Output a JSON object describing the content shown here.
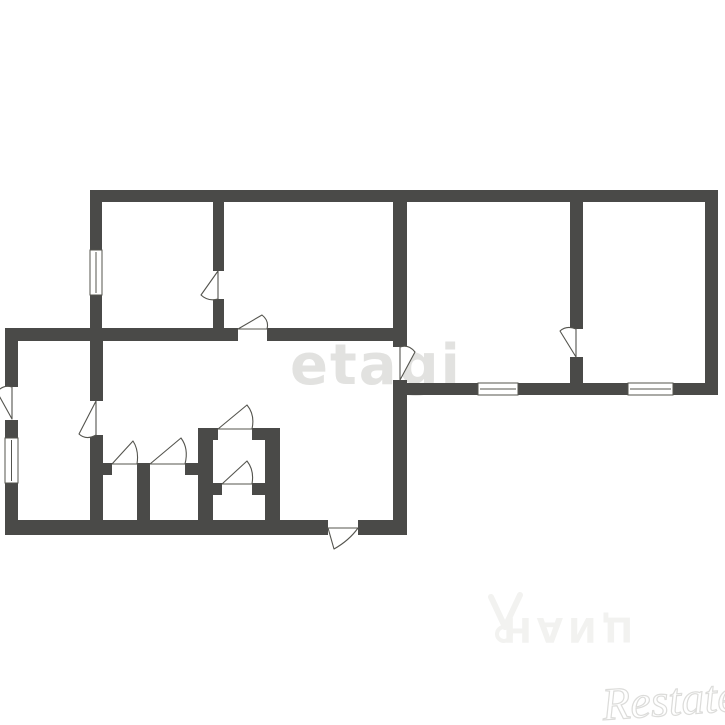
{
  "watermarks": {
    "etagi": {
      "text": "etagi",
      "color": "#e2e2e0"
    },
    "cian": {
      "text": "ЦИАН",
      "color": "#f2f2f0",
      "logo": "cian-person-pin-icon"
    },
    "restate": {
      "text": "Restate",
      "color": "#dcdcda"
    }
  },
  "plan": {
    "background": "#ffffff",
    "wall_color": "#4a4a48",
    "line_color": "#54544e",
    "walls": [
      {
        "x": 90,
        "y": 190,
        "w": 628,
        "h": 12
      },
      {
        "x": 705,
        "y": 190,
        "w": 13,
        "h": 205
      },
      {
        "x": 407,
        "y": 383,
        "w": 311,
        "h": 12
      },
      {
        "x": 90,
        "y": 190,
        "w": 12,
        "h": 151
      },
      {
        "x": 213,
        "y": 202,
        "w": 11,
        "h": 126
      },
      {
        "x": 393,
        "y": 202,
        "w": 14,
        "h": 145
      },
      {
        "x": 570,
        "y": 202,
        "w": 13,
        "h": 183
      },
      {
        "x": 5,
        "y": 328,
        "w": 388,
        "h": 13
      },
      {
        "x": 5,
        "y": 328,
        "w": 13,
        "h": 207
      },
      {
        "x": 5,
        "y": 520,
        "w": 402,
        "h": 15
      },
      {
        "x": 393,
        "y": 380,
        "w": 14,
        "h": 155
      },
      {
        "x": 90,
        "y": 341,
        "w": 13,
        "h": 179
      },
      {
        "x": 100,
        "y": 463,
        "w": 113,
        "h": 12
      },
      {
        "x": 137,
        "y": 475,
        "w": 13,
        "h": 46
      },
      {
        "x": 198,
        "y": 428,
        "w": 15,
        "h": 93
      },
      {
        "x": 265,
        "y": 428,
        "w": 15,
        "h": 93
      },
      {
        "x": 198,
        "y": 428,
        "w": 82,
        "h": 12
      },
      {
        "x": 213,
        "y": 483,
        "w": 52,
        "h": 12
      }
    ],
    "door_openings": [
      {
        "x": 213,
        "y": 271,
        "w": 11,
        "h": 28
      },
      {
        "x": 238,
        "y": 328,
        "w": 29,
        "h": 13
      },
      {
        "x": 570,
        "y": 329,
        "w": 13,
        "h": 28
      },
      {
        "x": 5,
        "y": 387,
        "w": 13,
        "h": 33
      },
      {
        "x": 90,
        "y": 401,
        "w": 13,
        "h": 34
      },
      {
        "x": 112,
        "y": 463,
        "w": 25,
        "h": 12
      },
      {
        "x": 150,
        "y": 463,
        "w": 35,
        "h": 12
      },
      {
        "x": 218,
        "y": 428,
        "w": 34,
        "h": 12
      },
      {
        "x": 222,
        "y": 483,
        "w": 30,
        "h": 12
      },
      {
        "x": 328,
        "y": 520,
        "w": 30,
        "h": 15
      }
    ],
    "doors": [
      {
        "hinge": [
          218,
          271
        ],
        "tip": [
          201,
          295
        ],
        "jamb": [
          218,
          299
        ]
      },
      {
        "hinge": [
          238,
          329
        ],
        "tip": [
          262,
          315
        ],
        "jamb": [
          267,
          329
        ]
      },
      {
        "hinge": [
          576,
          357
        ],
        "tip": [
          560,
          331
        ],
        "jamb": [
          576,
          329
        ]
      },
      {
        "hinge": [
          400,
          380
        ],
        "tip": [
          415,
          352
        ],
        "jamb": [
          400,
          347
        ]
      },
      {
        "hinge": [
          12,
          419
        ],
        "tip": [
          -3,
          392
        ],
        "jamb": [
          12,
          387
        ]
      },
      {
        "hinge": [
          96,
          401
        ],
        "tip": [
          79,
          434
        ],
        "jamb": [
          96,
          435
        ]
      },
      {
        "hinge": [
          112,
          464
        ],
        "tip": [
          133,
          441
        ],
        "jamb": [
          137,
          464
        ]
      },
      {
        "hinge": [
          150,
          464
        ],
        "tip": [
          181,
          438
        ],
        "jamb": [
          185,
          464
        ]
      },
      {
        "hinge": [
          218,
          429
        ],
        "tip": [
          247,
          405
        ],
        "jamb": [
          252,
          429
        ]
      },
      {
        "hinge": [
          222,
          484
        ],
        "tip": [
          247,
          461
        ],
        "jamb": [
          252,
          484
        ]
      },
      {
        "hinge": [
          328,
          528
        ],
        "tip": [
          334,
          549
        ],
        "jamb": [
          358,
          528
        ]
      }
    ],
    "windows": [
      {
        "x": 90,
        "y": 250,
        "w": 12,
        "h": 45,
        "orient": "v"
      },
      {
        "x": 5,
        "y": 438,
        "w": 13,
        "h": 45,
        "orient": "v"
      },
      {
        "x": 478,
        "y": 383,
        "w": 40,
        "h": 12,
        "orient": "h"
      },
      {
        "x": 628,
        "y": 383,
        "w": 45,
        "h": 12,
        "orient": "h"
      }
    ]
  }
}
